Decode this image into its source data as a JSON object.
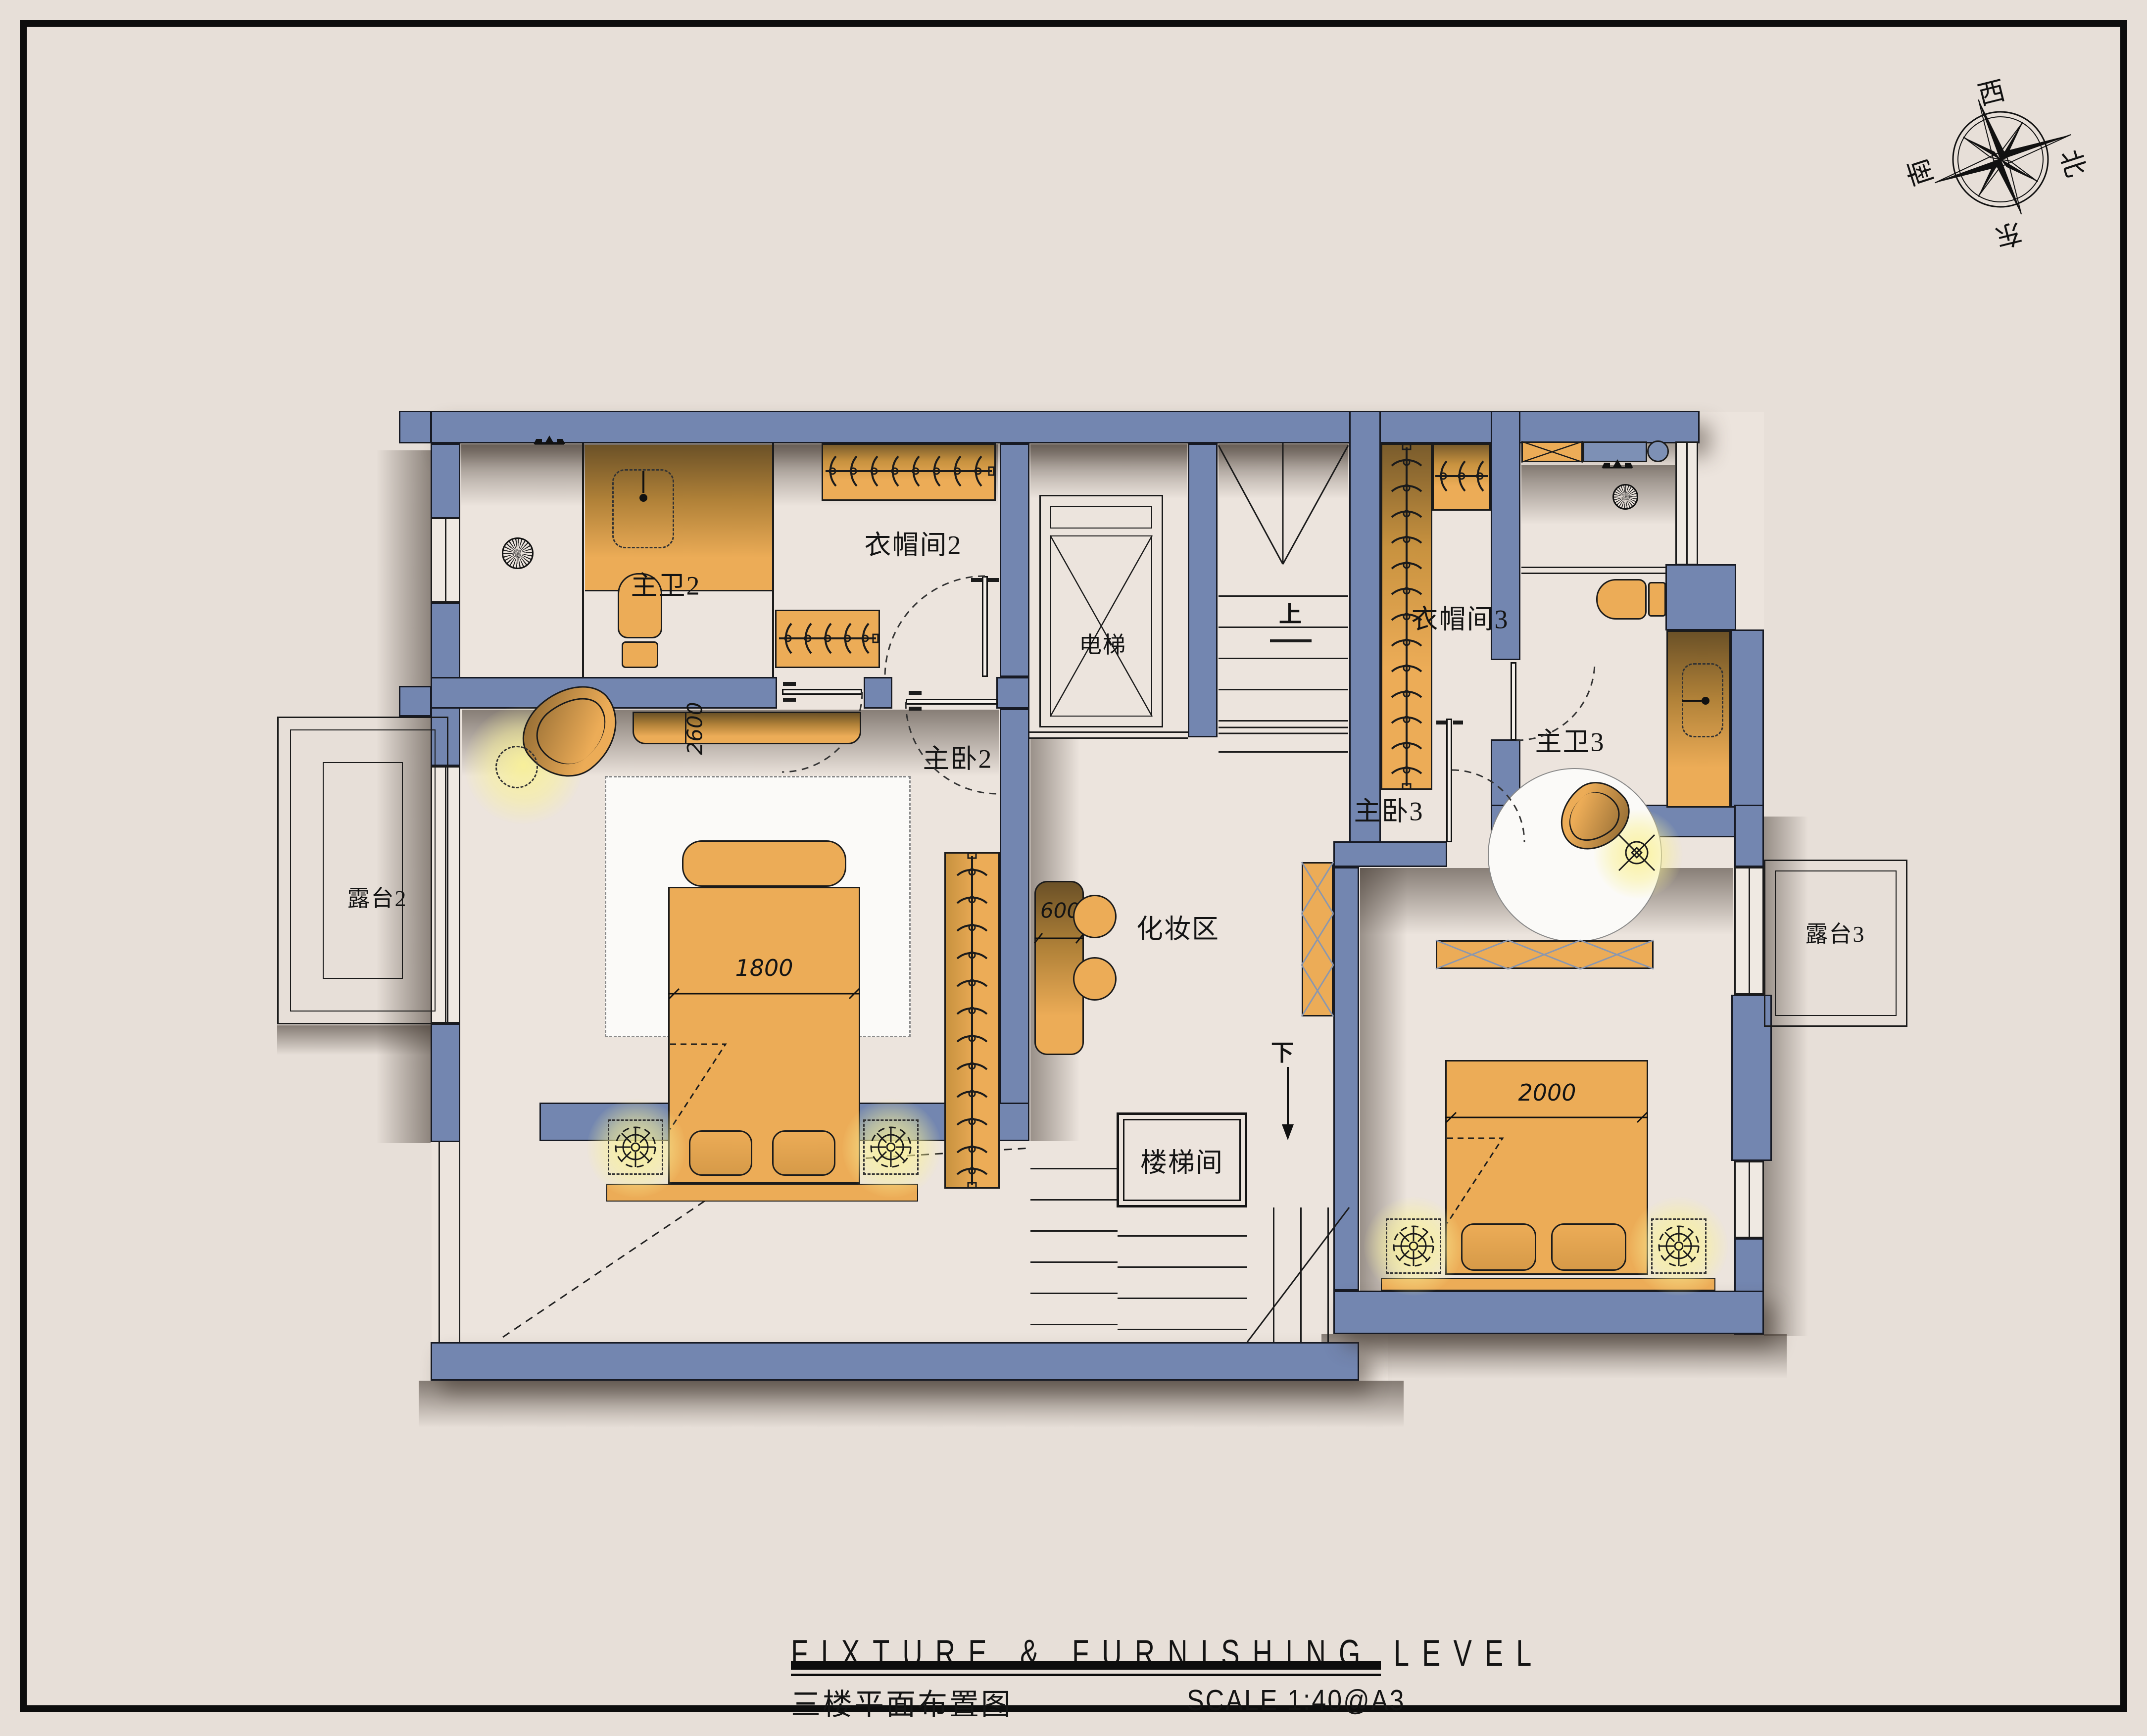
{
  "title_block": {
    "english": "FIXTURE & FURNISHING LEVEL",
    "chinese": "三楼平面布置图",
    "scale": "SCALE 1:40@A3"
  },
  "compass": {
    "west": "西",
    "north": "北",
    "east": "东",
    "south": "南"
  },
  "rooms": {
    "bath2": "主卫2",
    "closet2": "衣帽间2",
    "elevator": "电梯",
    "bedroom2": "主卧2",
    "closet3": "衣帽间3",
    "bath3": "主卫3",
    "makeup": "化妆区",
    "bedroom3": "主卧3",
    "stairwell": "楼梯间",
    "terrace2": "露台2",
    "terrace3": "露台3"
  },
  "stairs": {
    "up": "上",
    "down": "下"
  },
  "dimensions": {
    "bed2": "1800",
    "bed3": "2000",
    "table": "600",
    "counter": "2600"
  },
  "colors": {
    "page": "#e7dfd8",
    "floor": "#ece4dd",
    "wall": "#7386b0",
    "furniture": "#ecac57",
    "glow": "#f7f0a0",
    "line": "#1b1b1b"
  }
}
